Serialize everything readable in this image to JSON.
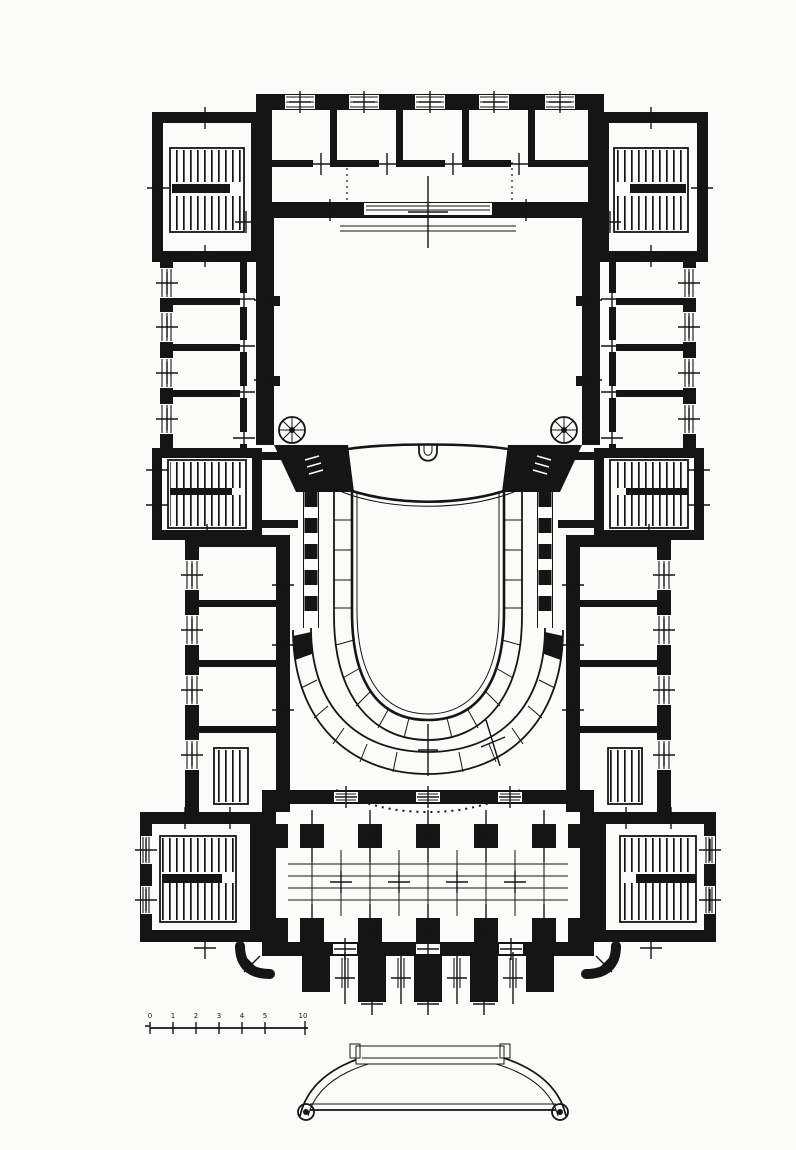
{
  "colors": {
    "ink": "#151515",
    "paper": "#fbfbf9"
  },
  "scale_bar": {
    "labels": [
      "0",
      "1",
      "2",
      "3",
      "4",
      "5",
      "10"
    ]
  },
  "symbols": {
    "opening_axis_marker": "plus-cross",
    "spiral_stair": "pinwheel-circle",
    "staircase": "parallel-tread-hatch",
    "window_opening": "triple-sill-lines",
    "wall_poche": "solid-black-fill"
  }
}
